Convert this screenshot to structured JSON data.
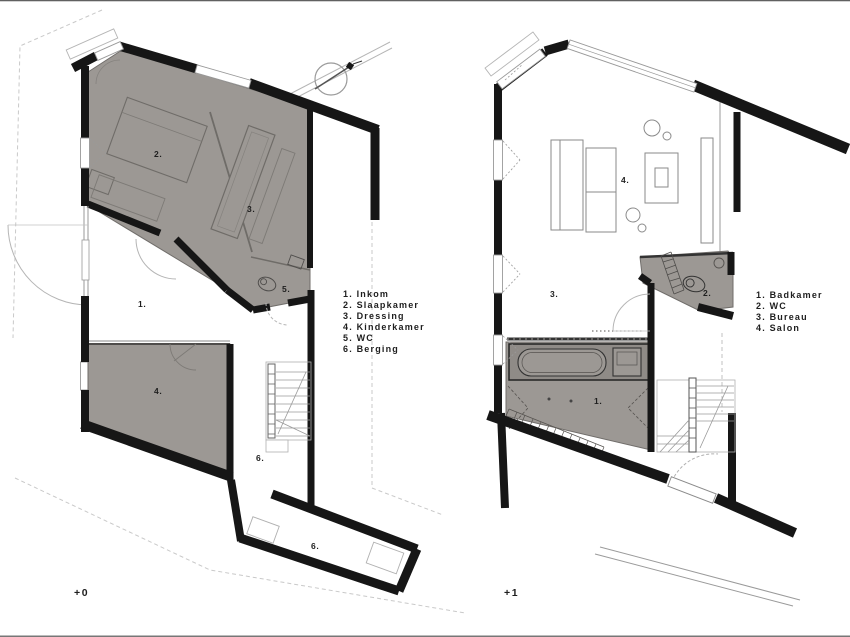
{
  "document": {
    "type": "architectural floor plans",
    "sheet_edges": true
  },
  "colors": {
    "wall": "#161616",
    "room_fill": "#9c9894",
    "room_fill_dark": "#8f8b87",
    "thin_line": "#8a8a8a",
    "light_line": "#b5b5b5",
    "dash_line": "#c2c2c2",
    "text": "#1e1e1e"
  },
  "icons": {
    "north_arrow": "compass-north-arrow"
  },
  "left_plan": {
    "floor_label": "+0",
    "room_labels": [
      "1.",
      "2.",
      "3.",
      "4.",
      "5.",
      "6.",
      "6."
    ],
    "legend": [
      "1. Inkom",
      "2. Slaapkamer",
      "3. Dressing",
      "4. Kinderkamer",
      "5. WC",
      "6. Berging"
    ]
  },
  "right_plan": {
    "floor_label": "+1",
    "room_labels": [
      "1.",
      "2.",
      "3.",
      "4."
    ],
    "legend": [
      "1. Badkamer",
      "2. WC",
      "3. Bureau",
      "4. Salon"
    ]
  }
}
